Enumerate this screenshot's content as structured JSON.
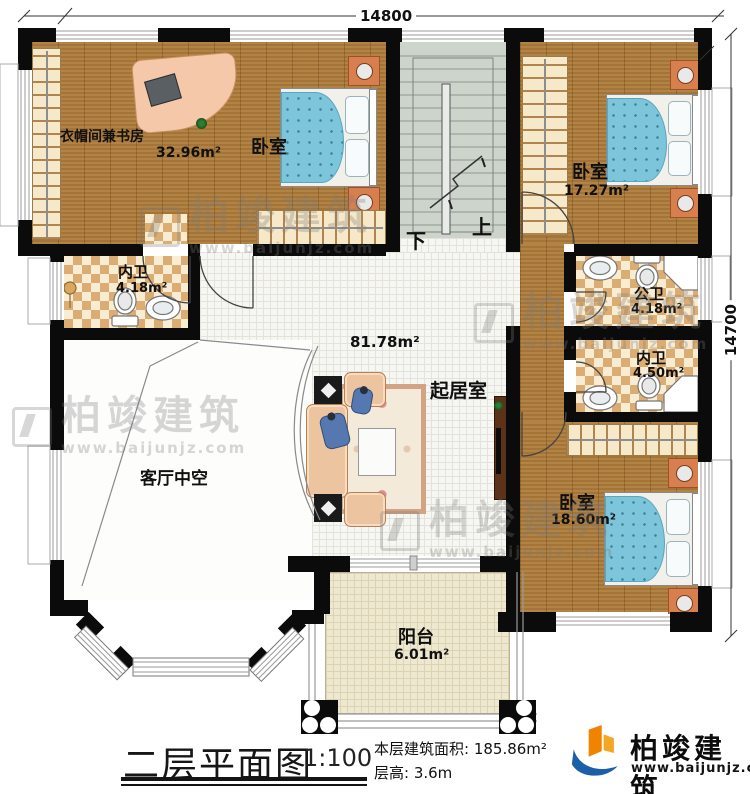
{
  "dimensions": {
    "width_label": "14800",
    "height_label": "14700"
  },
  "rooms": {
    "cloak_study": {
      "name": "衣帽间兼书房",
      "area": "32.96m²"
    },
    "bedroom_top": {
      "name": "卧室"
    },
    "bedroom_right": {
      "name": "卧室",
      "area": "17.27m²"
    },
    "bath_left": {
      "name": "内卫",
      "area": "4.18m²"
    },
    "bath_public": {
      "name": "公卫",
      "area": "4.18m²"
    },
    "bath_inner": {
      "name": "内卫",
      "area": "4.50m²"
    },
    "bedroom_bottom": {
      "name": "卧室",
      "area": "18.60m²"
    },
    "living": {
      "name": "起居室",
      "area": "81.78m²"
    },
    "void": {
      "name": "客厅中空"
    },
    "balcony": {
      "name": "阳台",
      "area": "6.01m²"
    }
  },
  "stairs": {
    "up_label": "上",
    "down_label": "下"
  },
  "title_block": {
    "title": "二层平面图",
    "scale": "1:100",
    "area_text": "本层建筑面积: 185.86m²",
    "floor_height_text": "层高: 3.6m"
  },
  "brand": {
    "name": "柏竣建筑",
    "website": "www.baijunjz.com"
  },
  "colors": {
    "wall": "#0b0b0b",
    "wood_floor": "#a8783a",
    "tile_floor": "#f6f6f2",
    "bath_checker": "#dcad72",
    "stair": "#cdd4cc",
    "balcony": "#efe8d0",
    "bed_blue": "#7cc5da",
    "sofa_tan": "#edc4a0",
    "logo_blue": "#1a5fa8",
    "logo_orange": "#f08300",
    "watermark_gray": "#7a7a7a"
  }
}
